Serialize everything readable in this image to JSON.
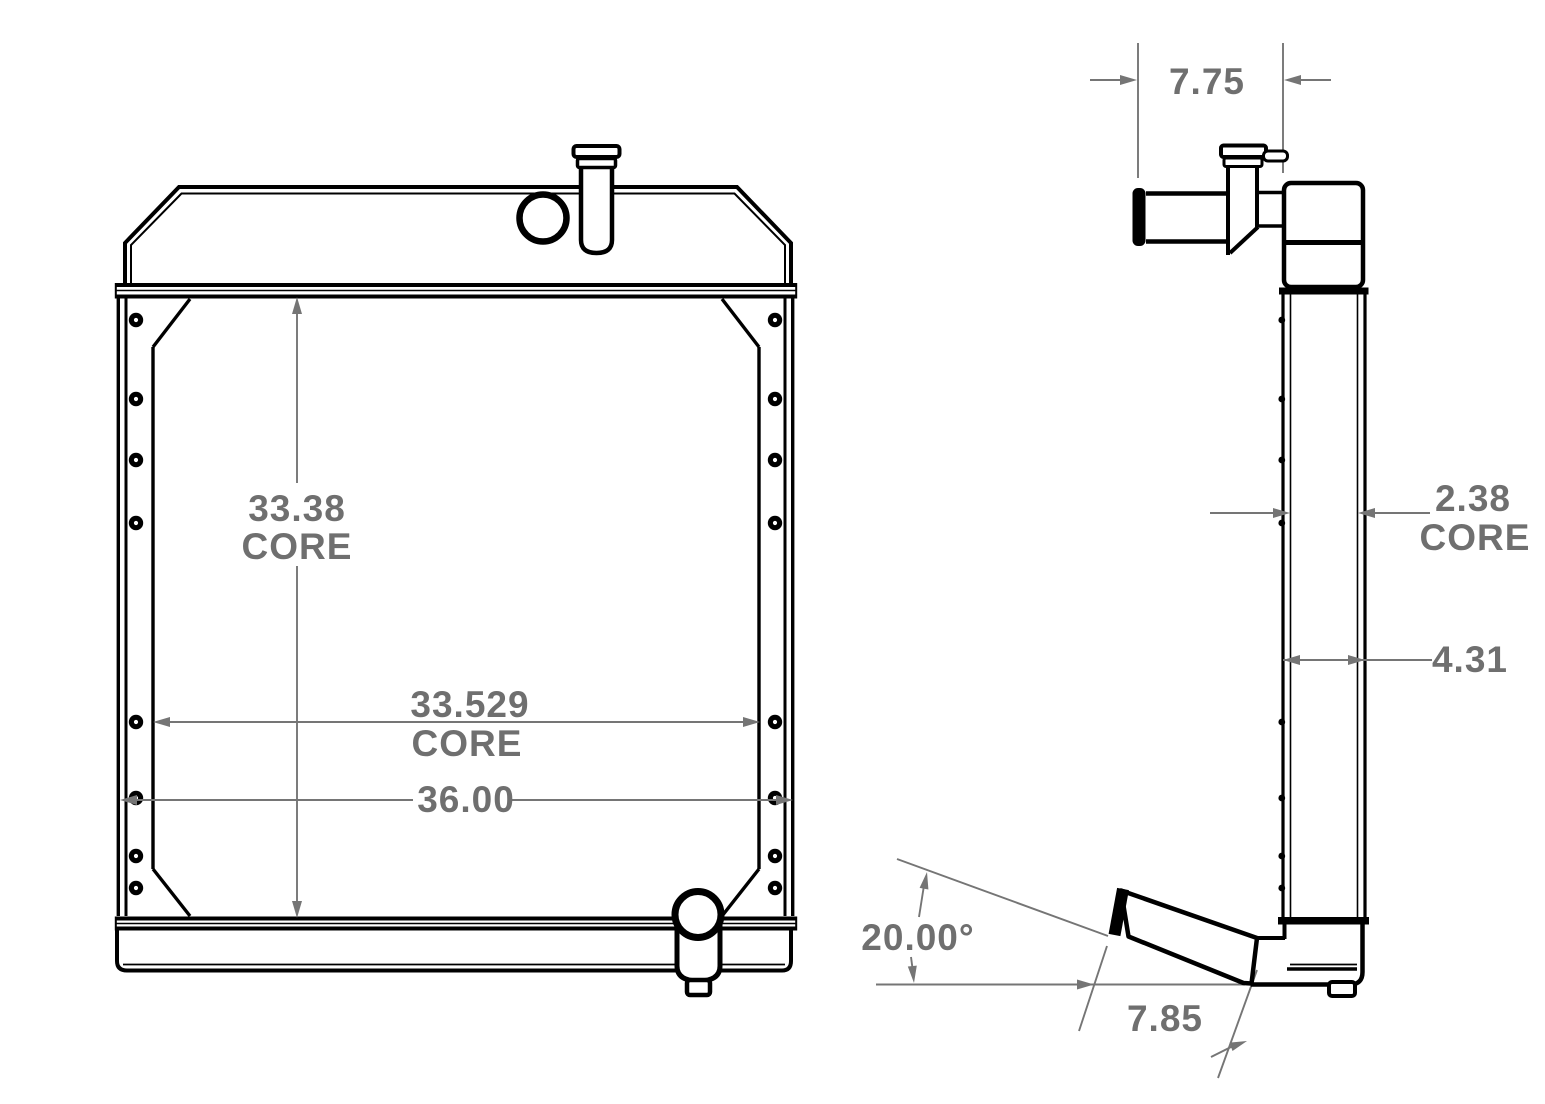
{
  "drawing": {
    "title": "radiator-technical-drawing",
    "front": {
      "core_height": {
        "value": "33.38",
        "label": "CORE"
      },
      "core_width": {
        "value": "33.529",
        "label": "CORE"
      },
      "overall_width": {
        "value": "36.00"
      }
    },
    "side": {
      "tank_depth": {
        "value": "7.75"
      },
      "core_depth": {
        "value": "2.38",
        "label": "CORE"
      },
      "overall_depth": {
        "value": "4.31"
      },
      "outlet_angle": {
        "value": "20.00°"
      },
      "outlet_length": {
        "value": "7.85"
      }
    },
    "colors": {
      "line": "#000000",
      "dimension": "#757575",
      "background": "#ffffff"
    }
  }
}
